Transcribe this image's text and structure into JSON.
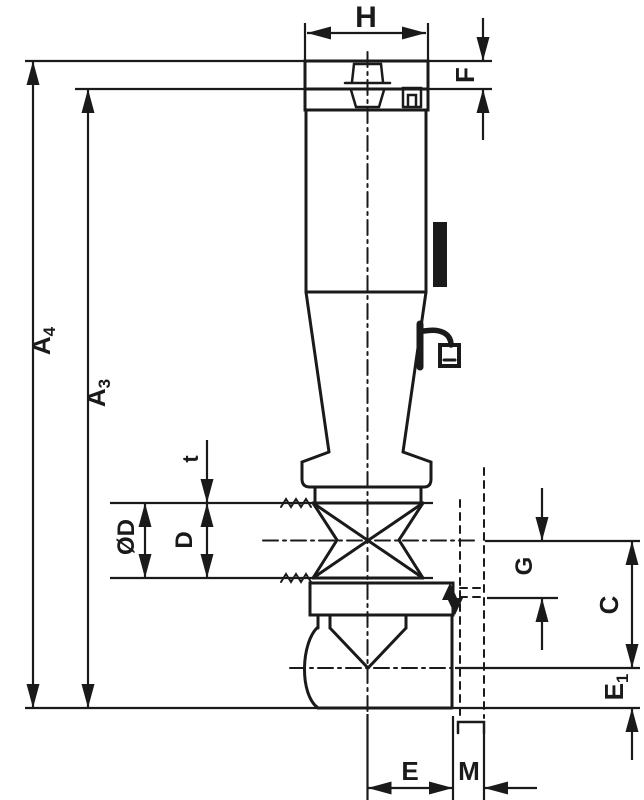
{
  "drawing": {
    "background": "#ffffff",
    "line_color": "#1a1a1a",
    "dimension_labels": {
      "h": "H",
      "f": "F",
      "a4_base": "A",
      "a4_sub": "4",
      "a3_base": "A",
      "a3_sub": "3",
      "t": "t",
      "phi_d": "ØD",
      "d": "D",
      "g": "G",
      "c": "C",
      "e1_base": "E",
      "e1_sub": "1",
      "e": "E",
      "m": "M"
    }
  }
}
